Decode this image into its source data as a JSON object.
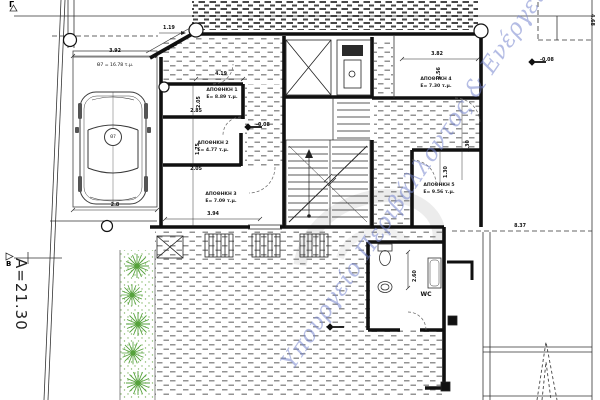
{
  "watermark": {
    "text": "Υπουργείο Περιβάλλοντος & Ενέργειας"
  },
  "markers": {
    "gamma": "Γ",
    "beta": "Β",
    "side_length": "Α=21.30"
  },
  "levels": {
    "left": "-0.08",
    "right": "-0.08"
  },
  "parking": {
    "stall_label": "Θ7 = 16.78 τ.μ.",
    "stall_id": "Θ7"
  },
  "rooms": {
    "r1": {
      "name": "ΑΠΟΘΗΚΗ 1",
      "area": "Ε= 8.89 τ.μ."
    },
    "r2": {
      "name": "ΑΠΟΘΗΚΗ 2",
      "area": "Ε= 4.77 τ.μ."
    },
    "r3": {
      "name": "ΑΠΟΘΗΚΗ 3",
      "area": "Ε= 7.09 τ.μ."
    },
    "r4": {
      "name": "ΑΠΟΘΗΚΗ 4",
      "area": "Ε= 7.30 τ.μ."
    },
    "r5": {
      "name": "ΑΠΟΘΗΚΗ 5",
      "area": "Ε= 9.56 τ.μ."
    },
    "wc": {
      "name": "WC"
    }
  },
  "dims": {
    "entry": "1.19",
    "diagonal": "1.45",
    "parking_width": "3.92",
    "parking_bottom": "2.8",
    "room1_width": "4.19",
    "room1_height": "2.05",
    "room1_inner": "2.85",
    "room2_height": "1.75",
    "room2_inner": "2.05",
    "room3_width": "3.94",
    "room4_width": "3.82",
    "room4_height": "2.56",
    "landing_a": "3.30",
    "landing_b": "1.30",
    "wc_height": "2.60",
    "yard": "8.37",
    "right_side": "4.68"
  },
  "icons": {
    "car": "car-top-view",
    "plant": "shrub-burst",
    "tree": "cypress-dashed",
    "level_marker": "diamond-spot-level",
    "stairs": "stair-flight",
    "elevator": "x-crossed-shaft"
  }
}
